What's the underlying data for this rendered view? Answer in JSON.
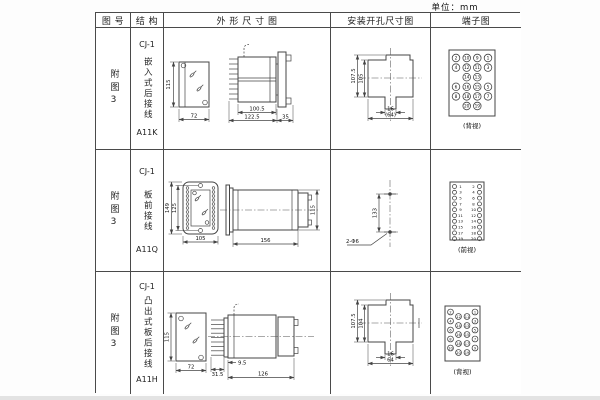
{
  "unit_label": "单位：mm",
  "headers": {
    "fig_no": "图 号",
    "structure": "结 构",
    "outline": "外 形 尺 寸 图",
    "install": "安装开孔尺寸图",
    "terminal": "端子图"
  },
  "rows": [
    {
      "fig_no": "附图3",
      "type": "CJ-1",
      "mounting": "嵌入式后接线",
      "model": "A11K",
      "outline": {
        "front_h": "115",
        "front_w": "72",
        "body_len": "100.5",
        "total_len": "122.5",
        "flange_w": "35"
      },
      "install": {
        "outer_h": "107.5",
        "inner_h": "105",
        "slot_w": "16",
        "overall_w": "(64)"
      },
      "terminal": {
        "caption": "(背视)",
        "cells": [
          {
            "c": 0,
            "r": 0,
            "n": "2"
          },
          {
            "c": 1,
            "r": 0,
            "n": "10"
          },
          {
            "c": 2,
            "r": 0,
            "n": "9"
          },
          {
            "c": 3,
            "r": 0,
            "n": "1"
          },
          {
            "c": 0,
            "r": 1,
            "n": "4"
          },
          {
            "c": 1,
            "r": 1,
            "n": "12"
          },
          {
            "c": 2,
            "r": 1,
            "n": "11"
          },
          {
            "c": 3,
            "r": 1,
            "n": "3"
          },
          {
            "c": 1,
            "r": 2,
            "n": "14"
          },
          {
            "c": 2,
            "r": 2,
            "n": "13"
          },
          {
            "c": 0,
            "r": 3,
            "n": "6"
          },
          {
            "c": 1,
            "r": 3,
            "n": "16"
          },
          {
            "c": 2,
            "r": 3,
            "n": "15"
          },
          {
            "c": 3,
            "r": 3,
            "n": "5"
          },
          {
            "c": 0,
            "r": 4,
            "n": "8"
          },
          {
            "c": 1,
            "r": 4,
            "n": "18"
          },
          {
            "c": 2,
            "r": 4,
            "n": "17"
          },
          {
            "c": 3,
            "r": 4,
            "n": "7"
          },
          {
            "c": 1,
            "r": 5,
            "n": "20"
          },
          {
            "c": 2,
            "r": 5,
            "n": "19"
          }
        ]
      }
    },
    {
      "fig_no": "附图3",
      "type": "CJ-1",
      "mounting": "板前接线",
      "model": "A11Q",
      "outline": {
        "front_outer_h": "149",
        "front_inner_h": "125",
        "front_w": "105",
        "body_len": "156",
        "body_h": "115"
      },
      "install": {
        "hole_dist": "133",
        "hole_label": "2-Φ6"
      },
      "terminal": {
        "caption": "(前视)",
        "cells": [
          {
            "c": 0,
            "r": 0,
            "t": "c"
          },
          {
            "c": 1,
            "r": 0,
            "n": "1",
            "t": "n"
          },
          {
            "c": 2,
            "r": 0,
            "n": "2",
            "t": "n"
          },
          {
            "c": 3,
            "r": 0,
            "t": "c"
          },
          {
            "c": 0,
            "r": 1,
            "t": "c"
          },
          {
            "c": 1,
            "r": 1,
            "n": "3",
            "t": "n"
          },
          {
            "c": 2,
            "r": 1,
            "n": "4",
            "t": "n"
          },
          {
            "c": 3,
            "r": 1,
            "t": "c"
          },
          {
            "c": 0,
            "r": 2,
            "t": "c"
          },
          {
            "c": 1,
            "r": 2,
            "n": "5",
            "t": "n"
          },
          {
            "c": 2,
            "r": 2,
            "n": "6",
            "t": "n"
          },
          {
            "c": 3,
            "r": 2,
            "t": "c"
          },
          {
            "c": 0,
            "r": 3,
            "t": "c"
          },
          {
            "c": 1,
            "r": 3,
            "n": "7",
            "t": "n"
          },
          {
            "c": 2,
            "r": 3,
            "n": "8",
            "t": "n"
          },
          {
            "c": 3,
            "r": 3,
            "t": "c"
          },
          {
            "c": 0,
            "r": 4,
            "t": "c"
          },
          {
            "c": 1,
            "r": 4,
            "n": "9",
            "t": "n"
          },
          {
            "c": 2,
            "r": 4,
            "n": "10",
            "t": "n"
          },
          {
            "c": 3,
            "r": 4,
            "t": "c"
          },
          {
            "c": 0,
            "r": 5,
            "t": "c"
          },
          {
            "c": 1,
            "r": 5,
            "n": "11",
            "t": "n"
          },
          {
            "c": 2,
            "r": 5,
            "n": "12",
            "t": "n"
          },
          {
            "c": 3,
            "r": 5,
            "t": "c"
          },
          {
            "c": 0,
            "r": 6,
            "t": "c"
          },
          {
            "c": 1,
            "r": 6,
            "n": "13",
            "t": "n"
          },
          {
            "c": 2,
            "r": 6,
            "n": "14",
            "t": "n"
          },
          {
            "c": 3,
            "r": 6,
            "t": "c"
          },
          {
            "c": 0,
            "r": 7,
            "t": "c"
          },
          {
            "c": 1,
            "r": 7,
            "n": "15",
            "t": "n"
          },
          {
            "c": 2,
            "r": 7,
            "n": "16",
            "t": "n"
          },
          {
            "c": 3,
            "r": 7,
            "t": "c"
          },
          {
            "c": 0,
            "r": 8,
            "t": "c"
          },
          {
            "c": 1,
            "r": 8,
            "n": "17",
            "t": "n"
          },
          {
            "c": 2,
            "r": 8,
            "n": "18",
            "t": "n"
          },
          {
            "c": 3,
            "r": 8,
            "t": "c"
          },
          {
            "c": 0,
            "r": 9,
            "t": "c"
          },
          {
            "c": 1,
            "r": 9,
            "n": "19",
            "t": "n"
          },
          {
            "c": 2,
            "r": 9,
            "n": "20",
            "t": "n"
          },
          {
            "c": 3,
            "r": 9,
            "t": "c"
          }
        ]
      }
    },
    {
      "fig_no": "附图3",
      "type": "CJ-1",
      "mounting": "凸出式板后接线",
      "model": "A11H",
      "outline": {
        "front_h": "115",
        "front_w": "72",
        "stud_len": "31.5",
        "base_w": "9.5",
        "body_len": "126"
      },
      "install": {
        "outer_h": "107.5",
        "inner_h": "104",
        "slot_w": "16",
        "overall_w": "64"
      },
      "terminal": {
        "caption": "(背视)",
        "cells": [
          {
            "c": 0,
            "r": 0,
            "n": "2"
          },
          {
            "c": 0,
            "r": 1,
            "n": "4"
          },
          {
            "c": 0,
            "r": 2,
            "n": "6"
          },
          {
            "c": 0,
            "r": 3,
            "n": "8"
          },
          {
            "c": 0,
            "r": 4,
            "n": "10"
          },
          {
            "c": 1,
            "r": 0.5,
            "n": "12"
          },
          {
            "c": 1,
            "r": 1.5,
            "n": "14"
          },
          {
            "c": 1,
            "r": 2.5,
            "n": "16"
          },
          {
            "c": 1,
            "r": 3.5,
            "n": "18"
          },
          {
            "c": 1,
            "r": 4.5,
            "n": "20"
          },
          {
            "c": 2,
            "r": 0.5,
            "n": "11"
          },
          {
            "c": 2,
            "r": 1.5,
            "n": "13"
          },
          {
            "c": 2,
            "r": 2.5,
            "n": "15"
          },
          {
            "c": 2,
            "r": 3.5,
            "n": "17"
          },
          {
            "c": 2,
            "r": 4.5,
            "n": "19"
          },
          {
            "c": 3,
            "r": 0,
            "n": "1"
          },
          {
            "c": 3,
            "r": 1,
            "n": "3"
          },
          {
            "c": 3,
            "r": 2,
            "n": "5"
          },
          {
            "c": 3,
            "r": 3,
            "n": "7"
          },
          {
            "c": 3,
            "r": 4,
            "n": "9"
          }
        ]
      }
    }
  ]
}
